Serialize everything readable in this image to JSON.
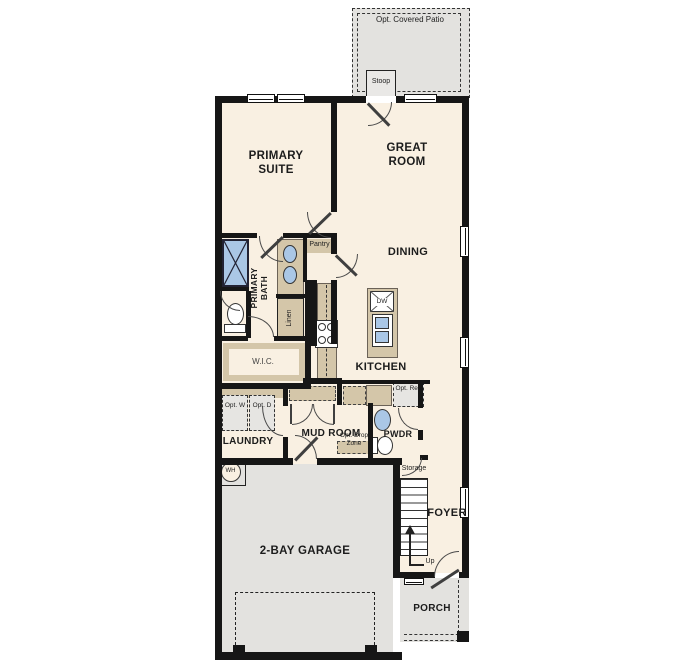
{
  "colors": {
    "floor": "#f9f0e2",
    "hard": "#e3e2df",
    "counter": "#d4c6a9",
    "wall": "#161616",
    "fixture": "#aac7e6",
    "optional": "#e6e5e2",
    "text": "#1c1c1c"
  },
  "labels": {
    "patio": "Opt. Covered Patio",
    "stoop": "Stoop",
    "primary_suite": "PRIMARY SUITE",
    "great_room": "GREAT ROOM",
    "dining": "DINING",
    "primary_bath": "PRIMARY BATH",
    "pantry": "Pantry",
    "linen": "Linen",
    "wic": "W.I.C.",
    "kitchen": "KITCHEN",
    "dishwasher": "DW",
    "opt_washer": "Opt. W",
    "opt_dryer": "Opt. D",
    "laundry": "LAUNDRY",
    "mud_room": "MUD ROOM",
    "opt_drop_zone": "Opt. Drop Zone",
    "powder": "PWDR",
    "opt_ref": "Opt. Ref.",
    "storage": "Storage",
    "foyer": "FOYER",
    "up": "Up",
    "water_heater": "WH",
    "garage": "2-BAY GARAGE",
    "porch": "PORCH"
  }
}
